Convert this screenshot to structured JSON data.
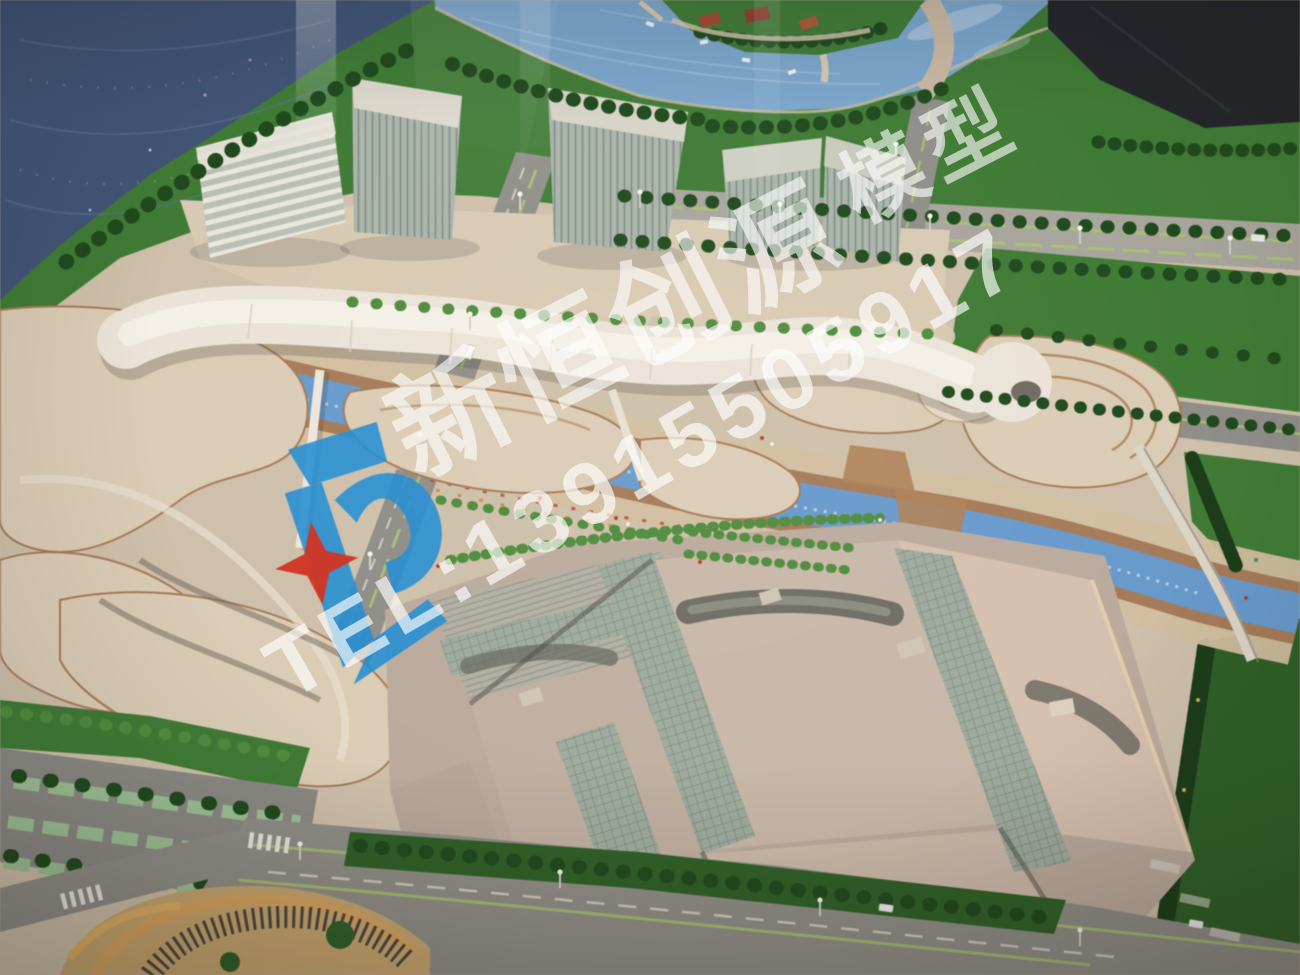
{
  "watermark": {
    "brand": "新恒创源",
    "suffix": "模型",
    "phone": "TEL:13915505917",
    "logo": {
      "description": "blue monogram with four-point red star",
      "icons": [
        "kc-monogram-icon",
        "four-point-star-icon"
      ]
    }
  },
  "scene": {
    "subject": "aerial photo of an architectural scale model of a riverside mixed-use development",
    "regions": [
      "dark sea",
      "river with marina and green island",
      "glass office towers",
      "white ribbon canopy building",
      "blue canal with footbridges",
      "terraced organic low-rise buildings",
      "exhibition hall roofs",
      "tree-lined boulevards",
      "parking lot",
      "lawns"
    ]
  },
  "palette": {
    "sea_dark": "#415577",
    "river_blue": "#7aa6cd",
    "canal_blue": "#669ace",
    "lawn_green": "#3e7c33",
    "lawn_dark": "#2e6126",
    "tree_green": "#1f4a1c",
    "hedge_green": "#1c3d18",
    "palm_green": "#4e8d3b",
    "ground_tan": "#cfc0a9",
    "plaza_tan": "#d9cab1",
    "blob_tan": "#dcccb4",
    "terrace_brown": "#a87b57",
    "promenade_tan": "#d3bf9f",
    "road_grey": "#908e88",
    "road_light": "#a8a59d",
    "lane_green": "#a9c36c",
    "canopy_white": "#ebe3d7",
    "glass_green": "#aab4aa",
    "glass_line": "#7e8d82",
    "roof_grey": "#cab8a8",
    "roof_pink": "#d7c0af",
    "dark_panel": "#24262a",
    "logo_blue": "#1f8ed6",
    "logo_red": "#d7301d",
    "wm_white": "#ffffff"
  }
}
